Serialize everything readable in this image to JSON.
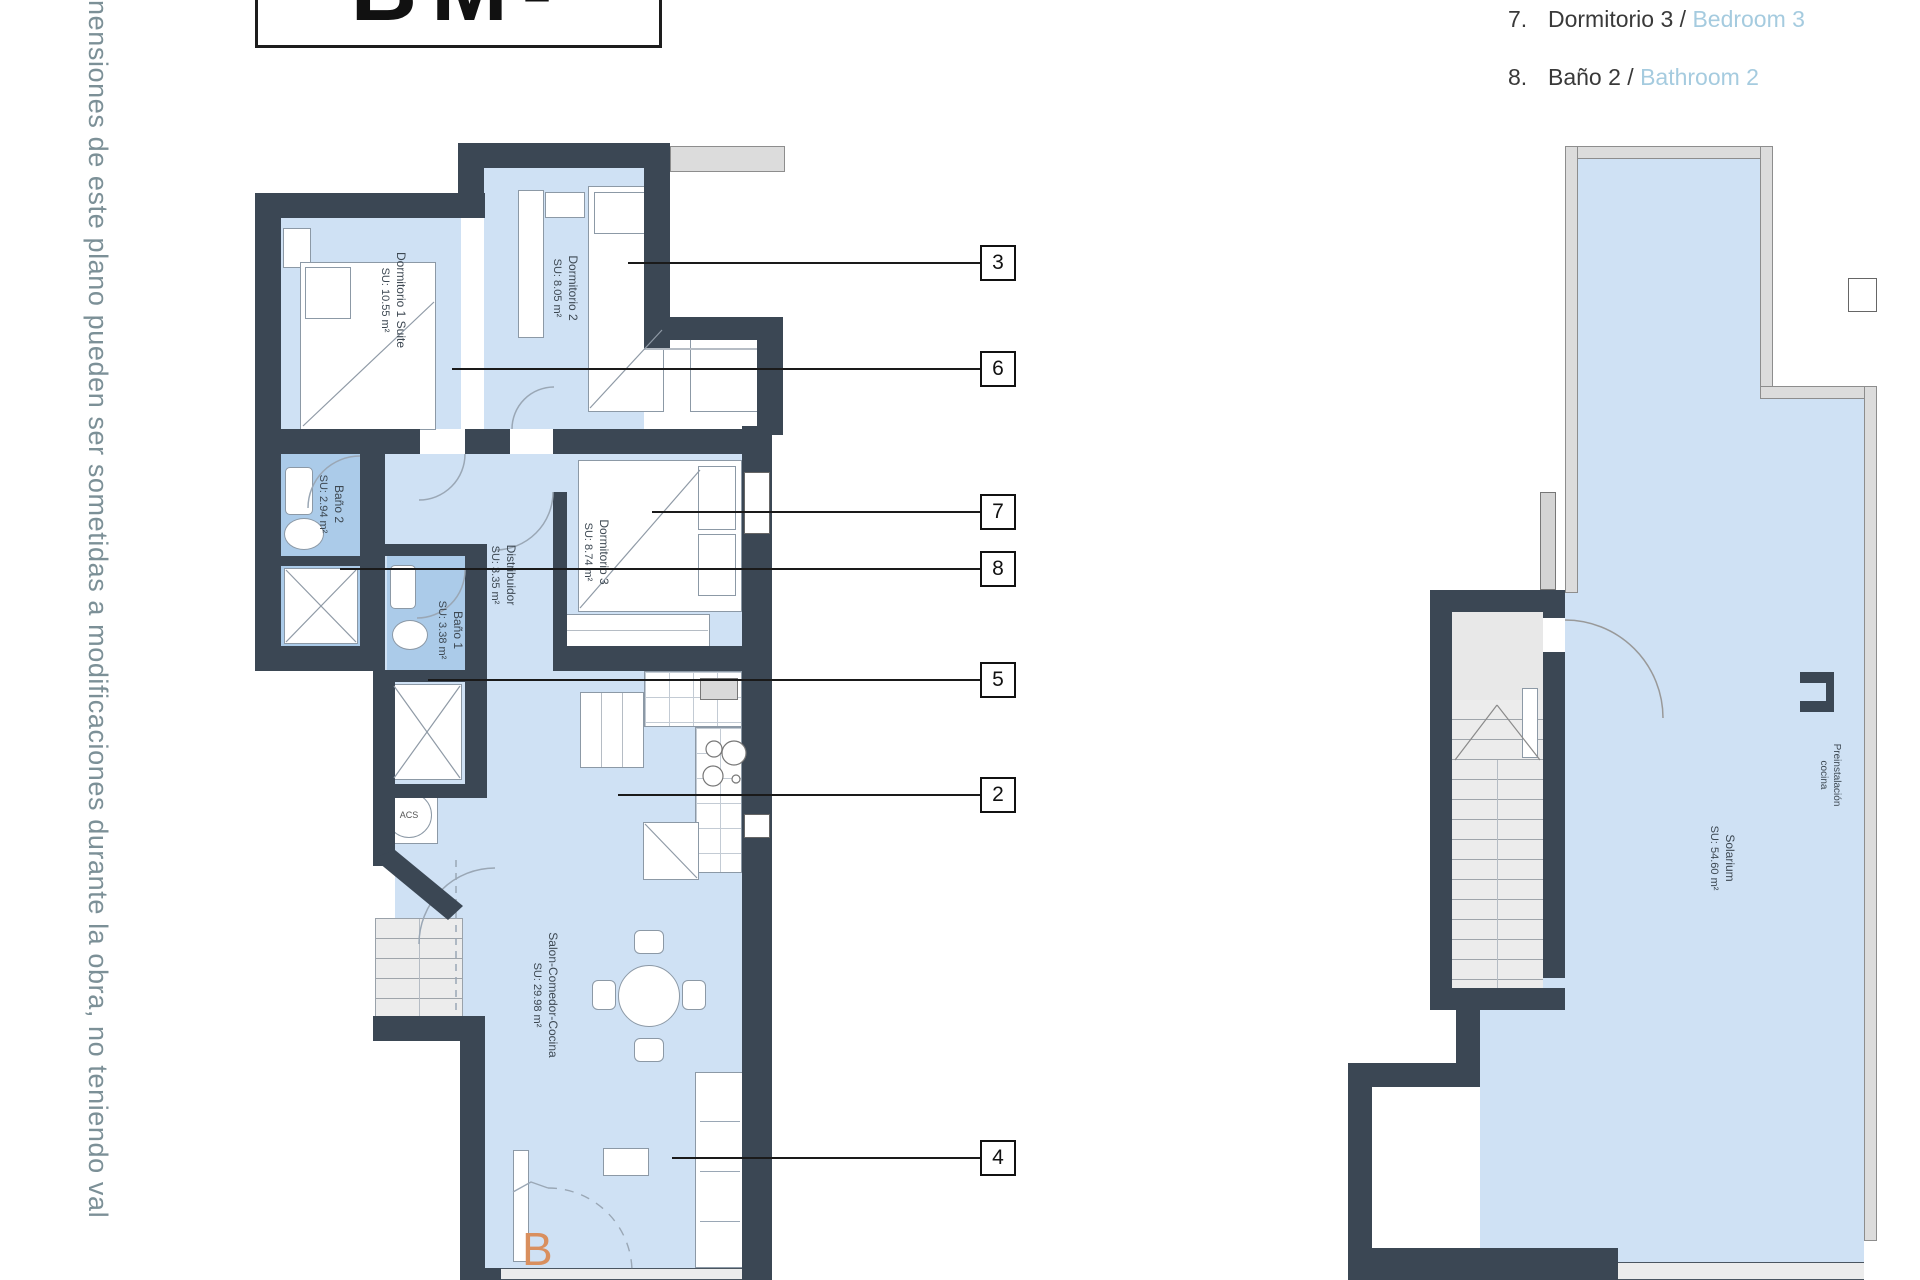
{
  "side_note": "nensiones de este plano pueden ser sometidas a modificaciones durante la obra, no teniendo val",
  "title_partial": "BM-B",
  "plan_letter": "B",
  "legend": {
    "items": [
      {
        "num": "7.",
        "es": "Dormitorio 3 / ",
        "en": "Bedroom 3"
      },
      {
        "num": "8.",
        "es": "Baño 2 / ",
        "en": "Bathroom 2"
      }
    ]
  },
  "rooms": {
    "dorm1": {
      "name": "Dormitorio 1 Suite",
      "area": "SU: 10.55 m²"
    },
    "dorm2": {
      "name": "Dormitorio 2",
      "area": "SU: 8.05 m²"
    },
    "dorm3": {
      "name": "Dormitorio 3",
      "area": "SU: 8.74 m²"
    },
    "bano1": {
      "name": "Baño 1",
      "area": "SU: 3.38 m²"
    },
    "bano2": {
      "name": "Baño 2",
      "area": "SU: 2.94 m²"
    },
    "distribuidor": {
      "name": "Distribuidor",
      "area": "SU: 3.35 m²"
    },
    "salon": {
      "name": "Salon-Comedor-Cocina",
      "area": "SU: 29.98 m²"
    },
    "solarium": {
      "name": "Solarium",
      "area": "SU: 54.60 m²"
    },
    "preinstalacion": {
      "line1": "Preinstalación",
      "line2": "cocina"
    },
    "acs": "ACS"
  },
  "callouts": [
    {
      "label": "3"
    },
    {
      "label": "6"
    },
    {
      "label": "7"
    },
    {
      "label": "8"
    },
    {
      "label": "5"
    },
    {
      "label": "2"
    },
    {
      "label": "4"
    }
  ],
  "colors": {
    "wall": "#3b4754",
    "room_fill": "#cfe1f4",
    "bath_fill": "#abcbe9",
    "legend_en": "#a5cbdf",
    "plan_letter": "#d98f5e",
    "note": "#7c9097"
  }
}
